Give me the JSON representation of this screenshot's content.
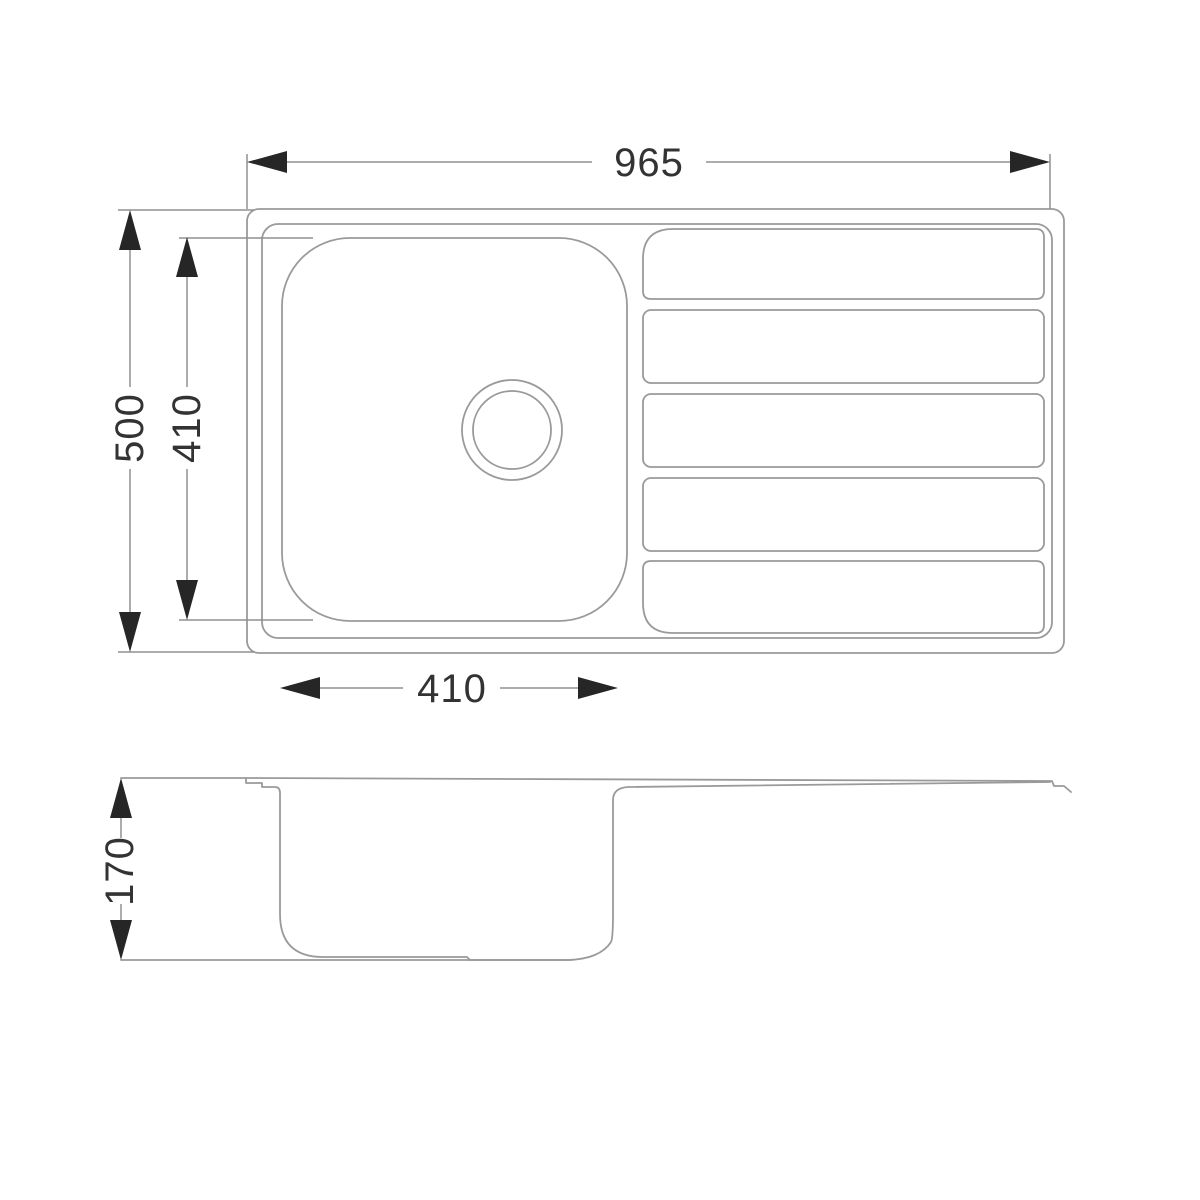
{
  "drawing": {
    "type": "kitchen-sink-dimension-drawing",
    "labels": {
      "overall_width": "965",
      "overall_depth": "500",
      "bowl_inner_depth": "410",
      "bowl_inner_width": "410",
      "bowl_height": "170"
    },
    "colors": {
      "background": "#ffffff",
      "line": "#9a9a9a",
      "dim_line": "#909090",
      "arrow": "#262626",
      "label": "#333333"
    }
  }
}
